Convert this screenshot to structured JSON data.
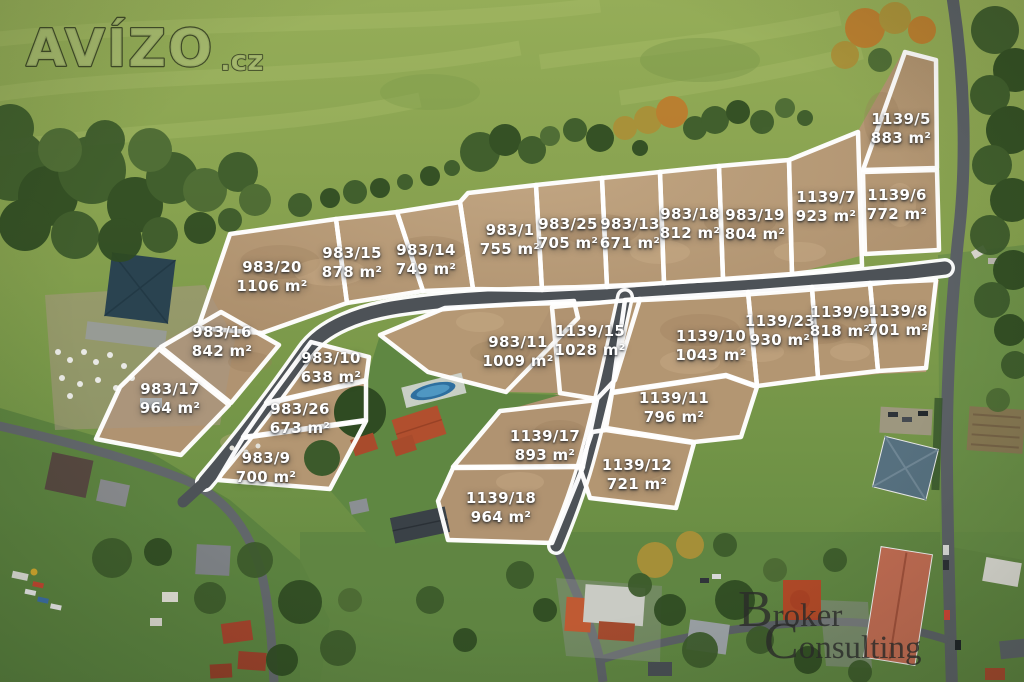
{
  "watermarks": {
    "avizo": {
      "name": "AVÍZO",
      "suffix": ".cz"
    },
    "broker": {
      "word1": "Broker",
      "word2": "Consulting"
    }
  },
  "plots": [
    {
      "id": "983/20",
      "area": "1106 m²",
      "x": 272,
      "y": 277
    },
    {
      "id": "983/15",
      "area": "878 m²",
      "x": 352,
      "y": 263
    },
    {
      "id": "983/14",
      "area": "749 m²",
      "x": 426,
      "y": 260
    },
    {
      "id": "983/1",
      "area": "755 m²",
      "x": 510,
      "y": 240
    },
    {
      "id": "983/25",
      "area": "705 m²",
      "x": 568,
      "y": 234
    },
    {
      "id": "983/13",
      "area": "671 m²",
      "x": 630,
      "y": 234
    },
    {
      "id": "983/18",
      "area": "812 m²",
      "x": 690,
      "y": 224
    },
    {
      "id": "983/19",
      "area": "804 m²",
      "x": 755,
      "y": 225
    },
    {
      "id": "1139/7",
      "area": "923 m²",
      "x": 826,
      "y": 207
    },
    {
      "id": "1139/5",
      "area": "883 m²",
      "x": 901,
      "y": 129
    },
    {
      "id": "1139/6",
      "area": "772 m²",
      "x": 897,
      "y": 205
    },
    {
      "id": "983/16",
      "area": "842 m²",
      "x": 222,
      "y": 342
    },
    {
      "id": "983/17",
      "area": "964 m²",
      "x": 170,
      "y": 399
    },
    {
      "id": "983/10",
      "area": "638 m²",
      "x": 331,
      "y": 368
    },
    {
      "id": "983/26",
      "area": "673 m²",
      "x": 300,
      "y": 419
    },
    {
      "id": "983/9",
      "area": "700 m²",
      "x": 266,
      "y": 468
    },
    {
      "id": "983/11",
      "area": "1009 m²",
      "x": 518,
      "y": 352
    },
    {
      "id": "1139/15",
      "area": "1028 m²",
      "x": 590,
      "y": 341
    },
    {
      "id": "1139/10",
      "area": "1043 m²",
      "x": 711,
      "y": 346
    },
    {
      "id": "1139/23",
      "area": "930 m²",
      "x": 780,
      "y": 331
    },
    {
      "id": "1139/9",
      "area": "818 m²",
      "x": 840,
      "y": 322
    },
    {
      "id": "1139/8",
      "area": "701 m²",
      "x": 898,
      "y": 321
    },
    {
      "id": "1139/11",
      "area": "796 m²",
      "x": 674,
      "y": 408
    },
    {
      "id": "1139/17",
      "area": "893 m²",
      "x": 545,
      "y": 446
    },
    {
      "id": "1139/12",
      "area": "721 m²",
      "x": 637,
      "y": 475
    },
    {
      "id": "1139/18",
      "area": "964 m²",
      "x": 501,
      "y": 508
    }
  ],
  "colors": {
    "boundary_line": "#ffffff",
    "label_text": "#ffffff",
    "new_road": "#4d5257",
    "asphalt_road": "#5b6065",
    "dirt": "#b39672",
    "grass": "#85a04e",
    "avizo_fill": "#a6ba70",
    "broker_orange": "#c23c22",
    "broker_text": "#2a2a2a"
  }
}
